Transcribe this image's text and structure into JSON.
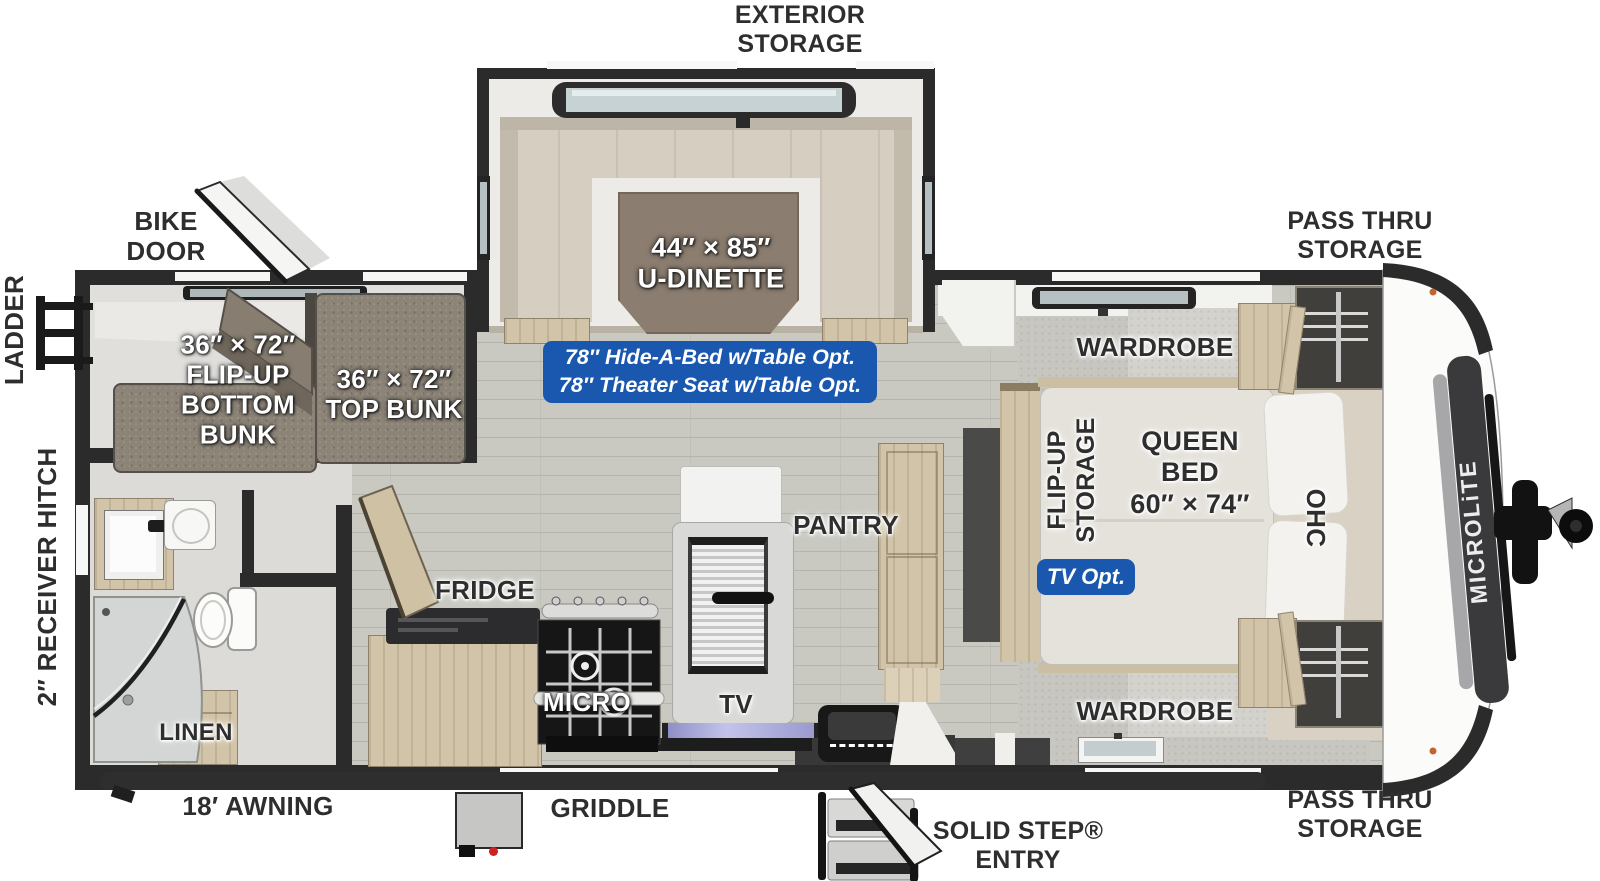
{
  "fp": {
    "brand": "MICROLiTE",
    "exterior": {
      "exterior_storage": [
        "EXTERIOR",
        "STORAGE"
      ],
      "pass_thru_top": [
        "PASS THRU",
        "STORAGE"
      ],
      "pass_thru_bottom": [
        "PASS THRU",
        "STORAGE"
      ],
      "bike_door": [
        "BIKE",
        "DOOR"
      ],
      "ladder": "LADDER",
      "receiver_hitch": "2″ RECEIVER HITCH",
      "awning": "18′ AWNING",
      "griddle": "GRIDDLE",
      "solid_step": [
        "SOLID STEP®",
        "ENTRY"
      ]
    },
    "dinette": {
      "size_label": "44″ × 85″",
      "name_label": "U-DINETTE",
      "options_badge": [
        "78″ Hide-A-Bed w/Table Opt.",
        "78″ Theater Seat w/Table Opt."
      ]
    },
    "bunks": {
      "bottom": [
        "36″ × 72″",
        "FLIP-UP",
        "BOTTOM",
        "BUNK"
      ],
      "top": [
        "36″ × 72″",
        "TOP BUNK"
      ]
    },
    "bath": {
      "linen": "LINEN"
    },
    "kitchen": {
      "fridge": "FRIDGE",
      "micro": "MICRO",
      "tv": "TV",
      "pantry": "PANTRY"
    },
    "bedroom": {
      "flip_up_storage": [
        "FLIP-UP",
        "STORAGE"
      ],
      "tv_opt": "TV Opt.",
      "queen_bed": [
        "QUEEN",
        "BED",
        "60″ × 74″"
      ],
      "ohc": "OHC",
      "wardrobe_top": "WARDROBE",
      "wardrobe_bottom": "WARDROBE"
    },
    "colors": {
      "badge_blue": "#1a57ae",
      "wall_dark": "#2b2b2b",
      "wood_cabinet": "#d2c4a9",
      "bench_beige": "#d6cec1",
      "table_brown": "#8b7d6f",
      "bunk_fabric": "#8d8478",
      "floor_wood": "#c9c9c2",
      "carpet_gray": "#c7c6c1",
      "cap_white": "#fbfbfa",
      "marker_orange": "#c0652e",
      "tv_screen_purple": "#a9a9d8"
    }
  }
}
